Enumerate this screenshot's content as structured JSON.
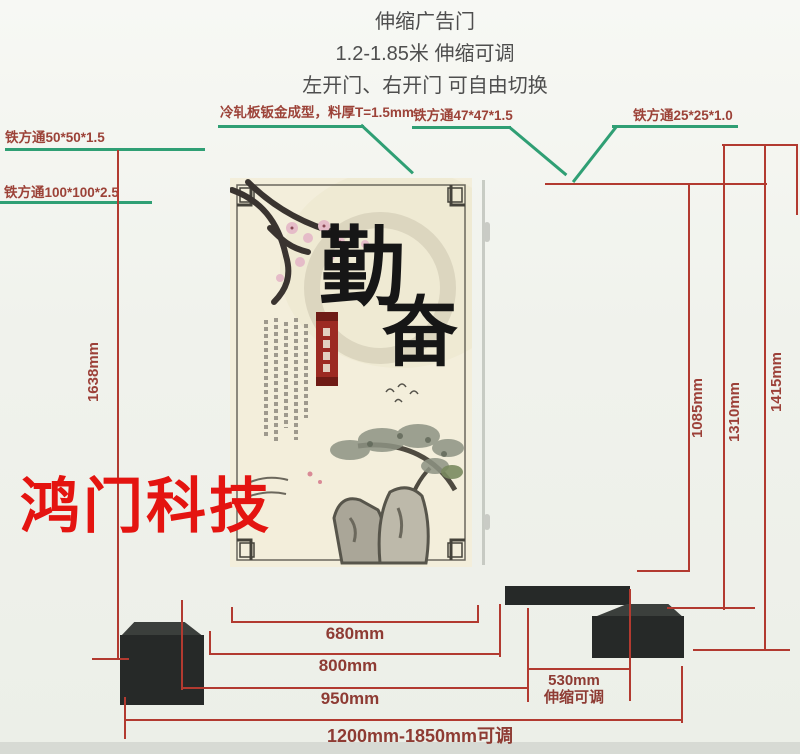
{
  "header": {
    "title": "伸缩广告门",
    "line2": "1.2-1.85米 伸缩可调",
    "line3": "左开门、右开门 可自由切换"
  },
  "callouts": {
    "cold_rolled_panel": "冷轧板钣金成型，料厚T=1.5mm",
    "square_tube_50": "铁方通50*50*1.5",
    "square_tube_100": "铁方通100*100*2.5",
    "square_tube_47": "铁方通47*47*1.5",
    "square_tube_25": "铁方通25*25*1.0"
  },
  "dimensions": {
    "left_total_height": "1638mm",
    "panel_height": "1085mm",
    "frame_height": "1310mm",
    "total_height": "1415mm",
    "panel_width": "680mm",
    "door_width": "800mm",
    "door_outer_width": "950mm",
    "telescope_width": "530mm",
    "telescope_note": "伸缩可调",
    "total_width_range": "1200mm-1850mm可调"
  },
  "watermark": "鸿门科技",
  "artwork": {
    "calligraphy_1": "勤",
    "calligraphy_2": "奋"
  },
  "colors": {
    "dimension_line": "#b23a30",
    "callout_line": "#2f9f74",
    "gate_metal": "#262928",
    "watermark_red": "#e41410",
    "panel_cream": "#f3eedb"
  }
}
